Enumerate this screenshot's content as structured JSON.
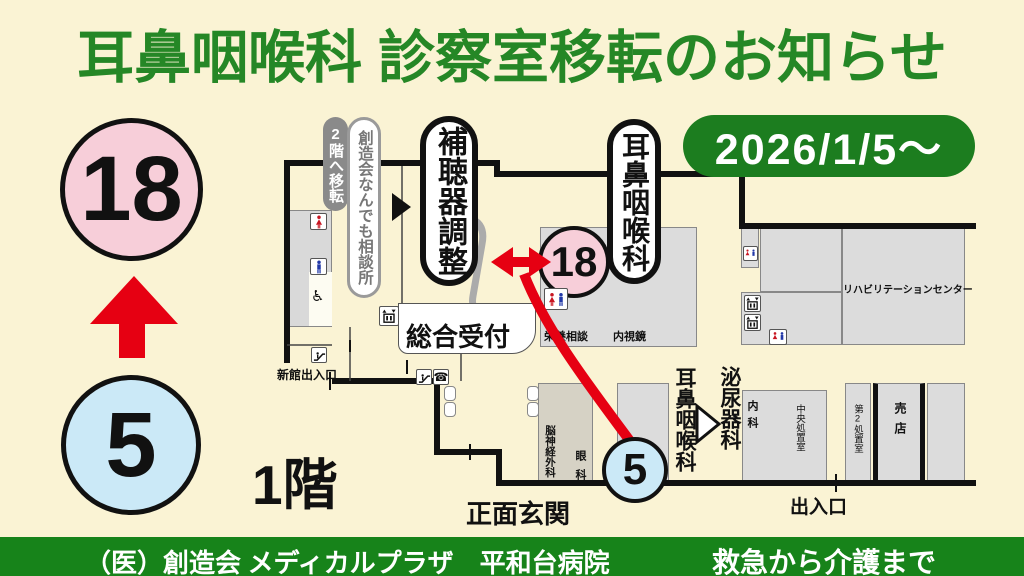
{
  "title": "耳鼻咽喉科 診察室移転のお知らせ",
  "date_badge": "2026/1/5〜",
  "move": {
    "from": "5",
    "to": "18"
  },
  "floor_label": "1階",
  "pills": {
    "moved_to_2f": "2階へ移転",
    "consultation_office": "創造会なんでも相談所",
    "hearing_aid": "補聴器調整",
    "ent": "耳鼻咽喉科"
  },
  "rooms": {
    "nutrition": "栄養相談",
    "endoscopy": "内視鏡",
    "rehabilitation": "リハビリテーションセンター",
    "neurosurgery": "脳神経外科",
    "ophthalmology": "眼科",
    "ent": "耳鼻咽喉科",
    "urology": "泌尿器科",
    "internal_medicine": "内科",
    "central_treatment": "中央処置室",
    "second_treatment": "第2処置室",
    "shop": "売店"
  },
  "labels": {
    "reception": "総合受付",
    "new_building_entrance": "新館出入口",
    "main_entrance": "正面玄関",
    "exit": "出入口"
  },
  "icons": {
    "wheelchair": "♿",
    "phone": "☎"
  },
  "footer": {
    "left": "（医）創造会 メディカルプラザ　平和台病院",
    "right": "救急から介護まで"
  },
  "colors": {
    "background": "#FAF3D4",
    "title_green": "#258726",
    "badge_green": "#1C7D1F",
    "footer_green": "#17831A",
    "pink": "#F7CED9",
    "light_blue": "#CBE9F7",
    "arrow_red": "#E60012",
    "room_gray": "#DCDCDC"
  }
}
